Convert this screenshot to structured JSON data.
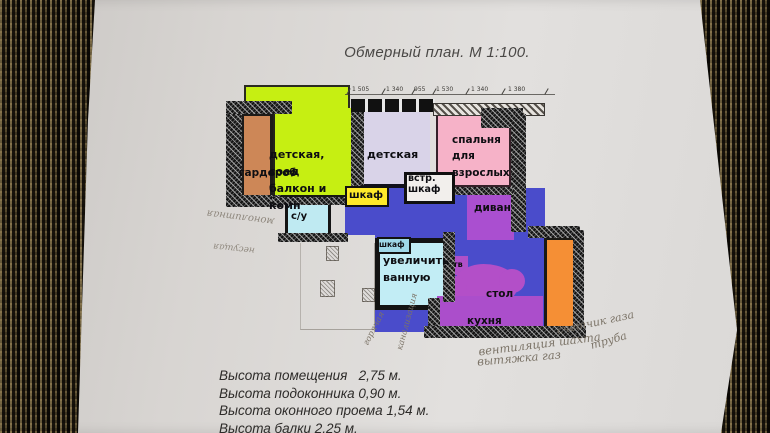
{
  "title": "Обмерный план. М 1:100.",
  "rooms": {
    "garderob": "гардероб",
    "kids_balcony": "детская,\nсоед\nбалкон и\nкомн",
    "kids": "детская",
    "bedroom": "спальня\nдля\nвзрослых",
    "closet_yellow": "шкаф",
    "closet_built_in": "встр.\nшкаф",
    "closet_small": "шкаф",
    "wc": "с/у",
    "bath": "увеличить\nванную",
    "sofa": "диван",
    "tv": "тв",
    "table": "стол",
    "kitchen": "кухня"
  },
  "dimensions": [
    "1 505",
    "1 340",
    "955",
    "1 530",
    "1 340",
    "1 380"
  ],
  "specs": [
    "Высота помещения   2,75 м.",
    "Высота подоконника 0,90 м.",
    "Высота оконного проема 1,54 м.",
    "Высота балки 2,25 м."
  ],
  "handwritten": {
    "left_1": "монолитная",
    "left_2": "несущая",
    "pipe_1": "горячая",
    "pipe_2": "канализация",
    "gas_1": "счетчик газа",
    "gas_2": "труба",
    "gas_3": "вентиляция шахта",
    "gas_4": "вытяжка газ"
  },
  "colors": {
    "room_green": "#c6ef12",
    "room_kids": "#d9d3e8",
    "room_bedroom": "#f6b2c8",
    "room_garderob": "#cd8757",
    "room_wc_bath": "#bfeaf2",
    "zone_blue": "#4a4ccb",
    "zone_magenta": "#ab4ecb",
    "balcony_orange": "#f58f35",
    "closet_yellow": "#ffe92a",
    "paper": "#dcd9d6",
    "fabric": "#2e2718"
  }
}
